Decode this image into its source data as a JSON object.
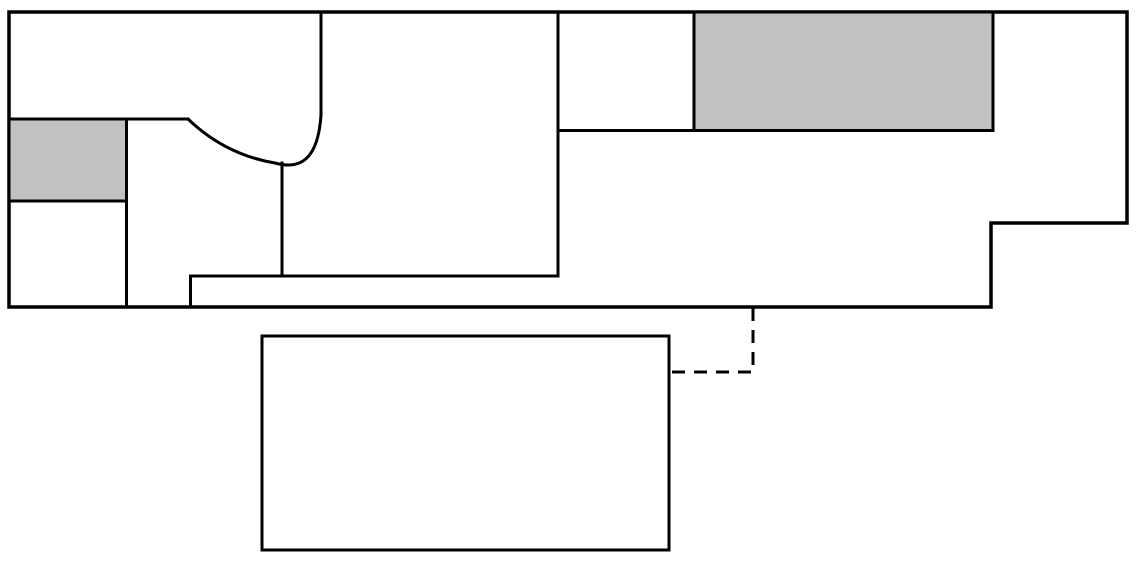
{
  "canvas": {
    "width": 1138,
    "height": 564,
    "background": "#ffffff"
  },
  "palette": {
    "line_color": "#000000",
    "shaded_fill": "#c1c1c1",
    "room_fill": "#ffffff"
  },
  "diagram": {
    "description": "floor-plan outline with two shaded rooms, curved wall, detached room, dashed connector",
    "default_stroke_width": 3,
    "shapes": [
      {
        "id": "building-outline",
        "type": "polygon",
        "points": "9,12 1127,12 1127,223 991,223 991,307 9,307",
        "fill": "#ffffff",
        "stroke_width": 3.5
      },
      {
        "id": "shaded-room-left",
        "type": "rect",
        "x": 9,
        "y": 119,
        "w": 117.5,
        "h": 82,
        "fill": "#c1c1c1",
        "stroke_width": 3
      },
      {
        "id": "shaded-room-right",
        "type": "rect",
        "x": 694,
        "y": 12,
        "w": 299,
        "h": 118.5,
        "fill": "#c1c1c1",
        "stroke_width": 3
      },
      {
        "id": "wall-upper-left-horizontal",
        "type": "line",
        "x1": 9,
        "y1": 119,
        "x2": 188,
        "y2": 119
      },
      {
        "id": "wall-left-column-vertical",
        "type": "line",
        "x1": 126.5,
        "y1": 119,
        "x2": 126.5,
        "y2": 307
      },
      {
        "id": "wall-curved",
        "type": "path",
        "d": "M 321 12 L 321 115 C 318 160 300 170 275 163 C 245 158 215 145 188 119"
      },
      {
        "id": "wall-center-vertical",
        "type": "line",
        "x1": 282,
        "y1": 163,
        "x2": 282,
        "y2": 276
      },
      {
        "id": "wall-lower-horizontal",
        "type": "line",
        "x1": 190.5,
        "y1": 276,
        "x2": 558,
        "y2": 276
      },
      {
        "id": "wall-lower-step-vertical",
        "type": "line",
        "x1": 190.5,
        "y1": 276,
        "x2": 190.5,
        "y2": 307
      },
      {
        "id": "wall-main-room-vertical",
        "type": "line",
        "x1": 558,
        "y1": 12,
        "x2": 558,
        "y2": 276
      },
      {
        "id": "wall-upper-right-horizontal",
        "type": "line",
        "x1": 558,
        "y1": 130.5,
        "x2": 993,
        "y2": 130.5
      },
      {
        "id": "wall-upper-right-vertical",
        "type": "line",
        "x1": 694,
        "y1": 12,
        "x2": 694,
        "y2": 130.5
      },
      {
        "id": "detached-room",
        "type": "rect",
        "x": 262,
        "y": 336,
        "w": 407,
        "h": 214,
        "fill": "#ffffff",
        "stroke_width": 3
      },
      {
        "id": "dashed-connector",
        "type": "path",
        "d": "M 753 308 L 753 372 L 671 372",
        "dash": "13 9",
        "linecap": "butt"
      }
    ]
  }
}
